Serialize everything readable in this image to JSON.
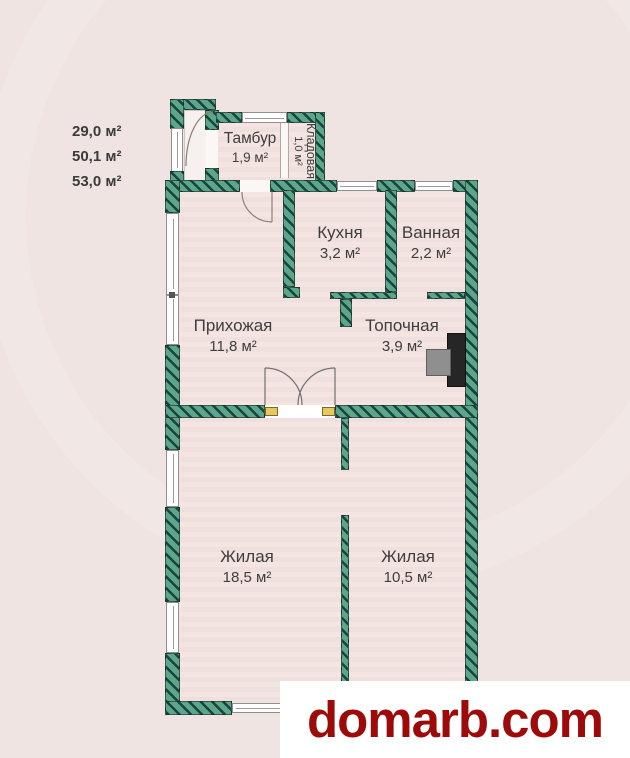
{
  "summary": [
    "29,0 м²",
    "50,1 м²",
    "53,0 м²"
  ],
  "rooms": [
    {
      "name": "Тамбур",
      "area": "1,9 м²"
    },
    {
      "name": "Кладовая",
      "area": "1,0 м²"
    },
    {
      "name": "Кухня",
      "area": "3,2 м²"
    },
    {
      "name": "Ванная",
      "area": "2,2 м²"
    },
    {
      "name": "Прихожая",
      "area": "11,8 м²"
    },
    {
      "name": "Топочная",
      "area": "3,9 м²"
    },
    {
      "name": "Жилая",
      "area": "18,5 м²"
    },
    {
      "name": "Жилая",
      "area": "10,5 м²"
    }
  ],
  "brand": {
    "site": "domarb.com"
  },
  "colors": {
    "wall_green": "#5ba78a",
    "wall_hatch": "#1a4240",
    "floor_pink": "#f3e3e0",
    "background": "#efe4e2",
    "brand_red": "#9d0a0a",
    "label_text": "#3e3e3e",
    "door_jamb_yellow": "#e9c75f"
  }
}
